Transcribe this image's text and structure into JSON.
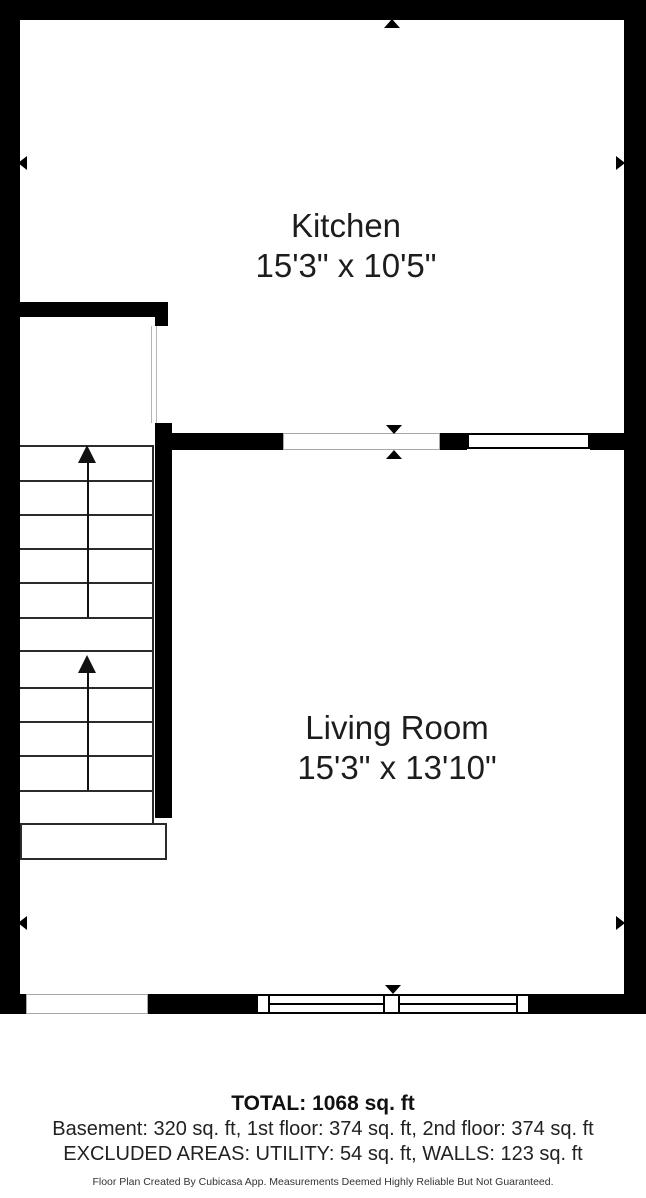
{
  "floor_plan": {
    "rooms": [
      {
        "name": "Kitchen",
        "dimensions": "15'3\" x 10'5\""
      },
      {
        "name": "Living Room",
        "dimensions": "15'3\" x 13'10\""
      }
    ],
    "features": [
      "staircase-up-two-flights",
      "doorway-opening",
      "windows"
    ],
    "colors": {
      "wall": "#000000",
      "stair_line": "#2b2b2b",
      "opening_outline": "#a8a8a8",
      "text": "#1d1d1d"
    }
  },
  "footer": {
    "total": "TOTAL: 1068 sq. ft",
    "floor_breakdown": "Basement: 320 sq. ft, 1st floor: 374 sq. ft, 2nd floor: 374 sq. ft",
    "excluded_areas": "EXCLUDED AREAS: UTILITY: 54 sq. ft, WALLS: 123 sq. ft",
    "disclaimer": "Floor Plan Created By Cubicasa App. Measurements Deemed Highly Reliable But Not Guaranteed."
  }
}
